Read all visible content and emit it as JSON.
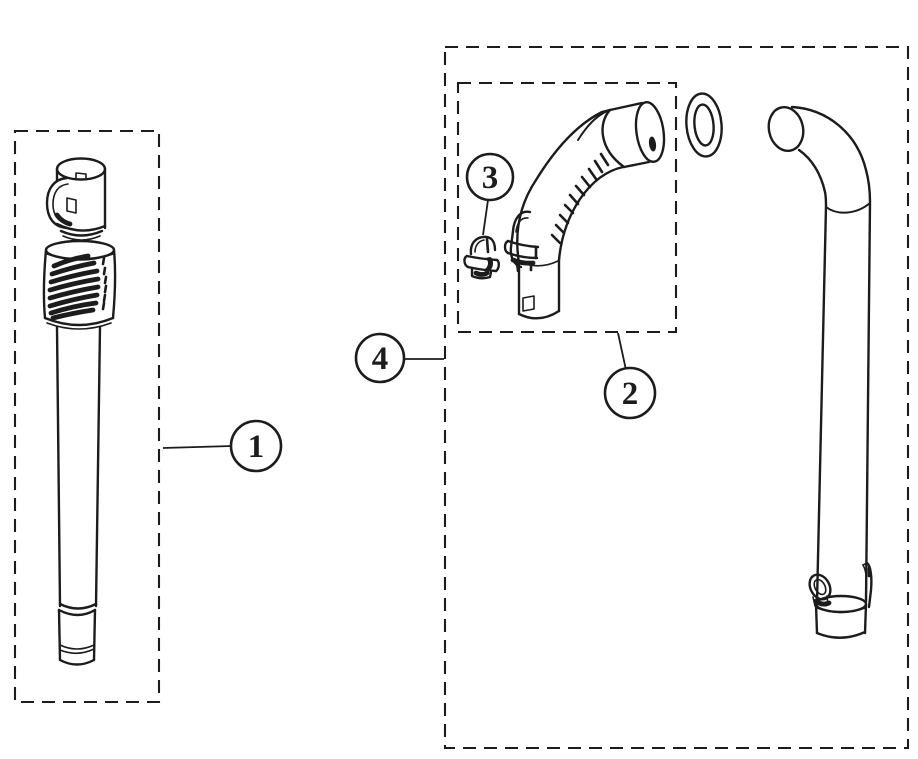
{
  "diagram": {
    "background_color": "#ffffff",
    "ink_color": "#1c1c1c",
    "callouts": [
      {
        "label": "1"
      },
      {
        "label": "2"
      },
      {
        "label": "3"
      },
      {
        "label": "4"
      }
    ]
  }
}
